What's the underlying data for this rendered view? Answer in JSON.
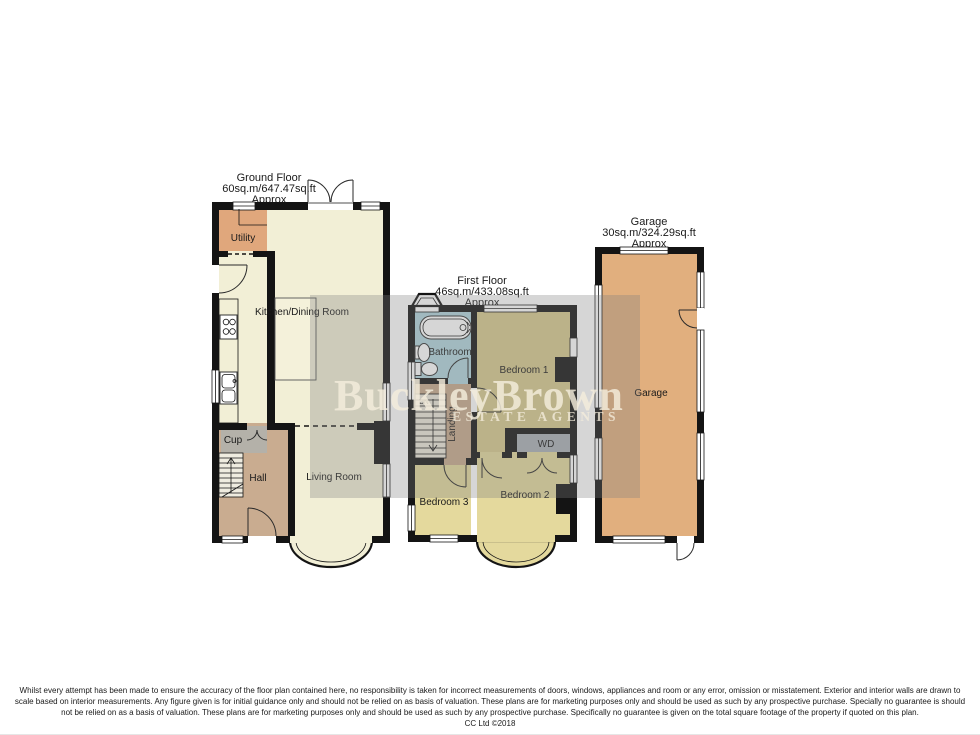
{
  "watermark": {
    "brand": "BuckleyBrown",
    "tagline": "ESTATE AGENTS",
    "band_color": "rgba(128,128,128,0.32)",
    "text_color": "#f5eedd"
  },
  "plans": {
    "ground_floor": {
      "title": "Ground Floor",
      "area": "60sq.m/647.47sq.ft",
      "approx": "Approx",
      "rooms": {
        "utility": "Utility",
        "kitchen": "Kitchen/Dining Room",
        "cup": "Cup",
        "hall": "Hall",
        "living": "Living Room"
      }
    },
    "first_floor": {
      "title": "First Floor",
      "area": "46sq.m/433.08sq.ft",
      "approx": "Approx",
      "rooms": {
        "bathroom": "Bathroom",
        "bedroom1": "Bedroom 1",
        "landing": "Landing",
        "dn": "DN",
        "wd": "WD",
        "bedroom2": "Bedroom 2",
        "bedroom3": "Bedroom 3"
      }
    },
    "garage": {
      "title": "Garage",
      "area": "30sq.m/324.29sq.ft",
      "approx": "Approx",
      "rooms": {
        "garage": "Garage"
      }
    }
  },
  "colors": {
    "wall": "#141414",
    "cream": "#f2efd6",
    "utility": "#e0a77c",
    "hall": "#c9ac90",
    "cup": "#b4b1a9",
    "bathroom": "#b2d5dd",
    "bedroom1": "#d8ca8e",
    "bedroom23": "#e4d99d",
    "landing": "#c7aa8c",
    "wd": "#aab0b6",
    "garage": "#e1af7e",
    "stairs": "#efece0"
  },
  "disclaimer": {
    "lines": [
      "Whilst every attempt has been made to ensure the accuracy of the floor plan contained here, no responsibility is taken for incorrect measurements of doors, windows, appliances and room or any error, omission or misstatement. Exterior and interior walls are drawn to",
      "scale based on interior measurements. Any figure given is for initial guidance only and should not be relied on as basis of valuation. These plans are for marketing purposes only and should be used as such by any prospective purchase. Specially no guarantee is should",
      "not be relied on as a basis of valuation. These plans are for marketing purposes only and should be used as such by any prospective purchase. Specifically no guarantee is given on the total square footage of the property if quoted on this plan."
    ],
    "copyright": "CC Ltd ©2018"
  }
}
